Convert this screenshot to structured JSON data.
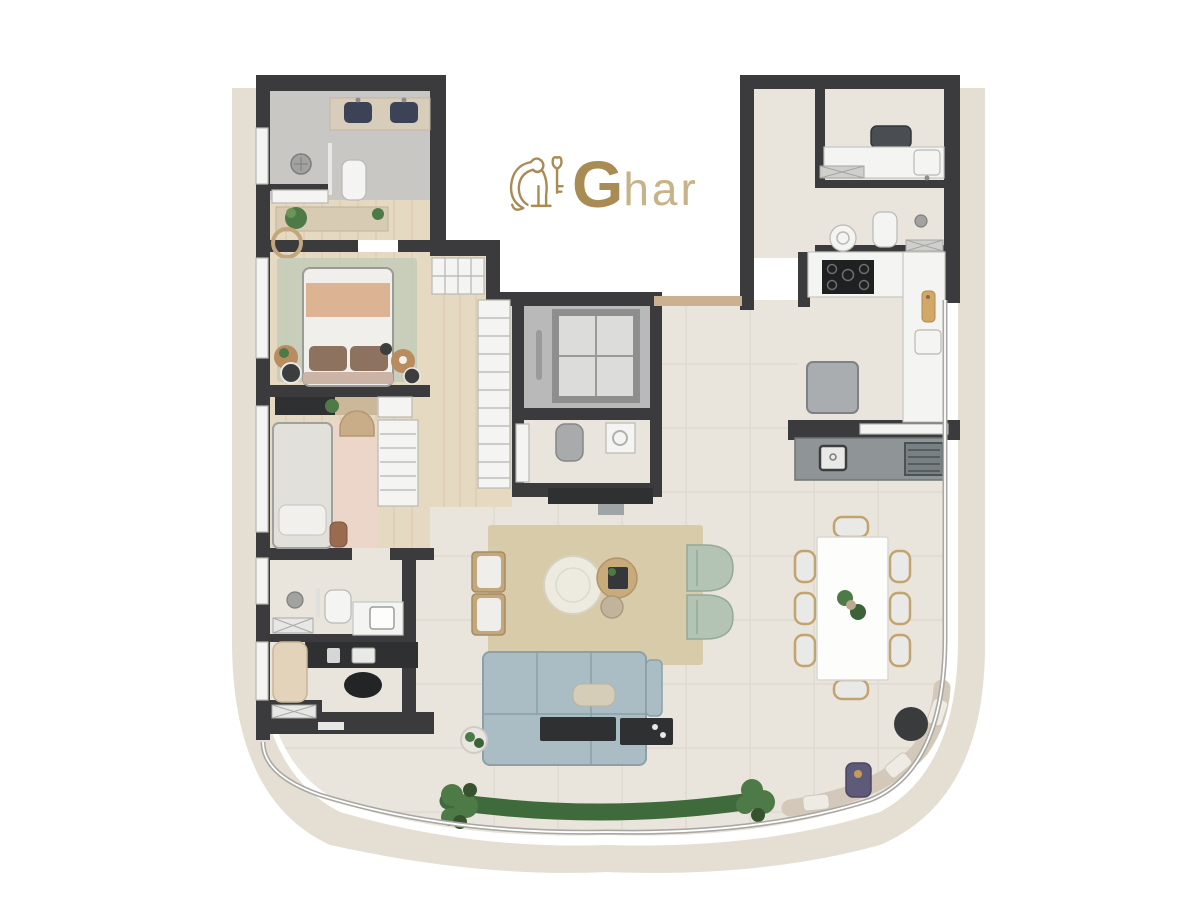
{
  "logo": {
    "initial": "G",
    "rest": "har",
    "icon": "lion-holding-key",
    "gold": "#a98c54",
    "gold_light": "#c8b287"
  },
  "icons": {
    "brand": "lion-holding-key-icon"
  },
  "palette": {
    "wall": "#3b3b3d",
    "band": "#e4ded3",
    "tile": "#eae5dc",
    "grout": "#dcd6ca",
    "wood": "#e6d9c2",
    "wood_line": "#c9b492",
    "stone": "#c9c7c3",
    "lobby": "#b9b9ba",
    "elev_car": "#dcdcda",
    "elev_edge": "#8e8e8e",
    "glass": "#aaa8a3",
    "white_fixture": "#f4f4f2",
    "fixture_edge": "#b9b9b5",
    "counter_edge": "#c6c6c2",
    "navy": "#3d4356",
    "sofa": "#aabdc4",
    "sofa_edge": "#8ba0a8",
    "sage": "#b3c4b4",
    "sage_edge": "#95aa97",
    "rug": "#d8cba9",
    "pink_rug": "#ecd6c9",
    "pouf": "#edebe0",
    "oak": "#c9aa7b",
    "dark_furn": "#2f3032",
    "appliance": "#a9adaf",
    "bbq": "#8f9496",
    "grill": "#798084",
    "grass": "#3f6b3c",
    "plant": "#4d7a46",
    "peach": "#dcb393",
    "pillow_brown": "#8d7260",
    "sheet": "#f0efeb",
    "headboard": "#cbb4a6",
    "chaise": "#e3d3bb",
    "purple": "#5e5a79",
    "tan_door": "#ccb190",
    "bench": "#d3c8b9",
    "cushion": "#eeebe4"
  }
}
